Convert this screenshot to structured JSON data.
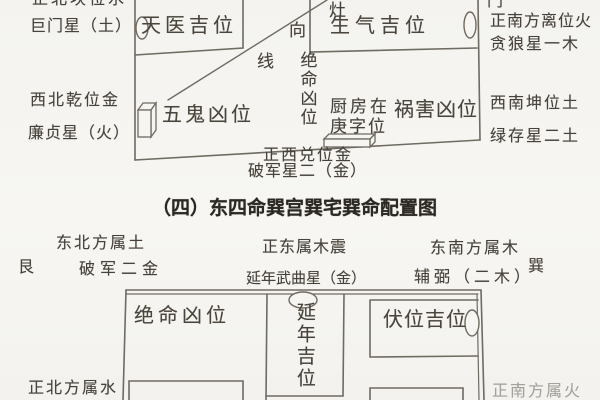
{
  "palette": {
    "paper": "#f6f5f1",
    "ink": "#47423b",
    "line": "#6f6a62",
    "heading_ink": "#2c2923"
  },
  "upper_diagram": {
    "nw_corner": {
      "line1": "正北坎位水",
      "line2": "巨门星（土）"
    },
    "rooms": {
      "tianyi": "天医吉位",
      "shengqi": "生气吉位",
      "wugui": "五鬼凶位",
      "huohai": "祸害凶位"
    },
    "stove_facing_line": {
      "zao": "灶",
      "xiang": "向",
      "xian": "线"
    },
    "jueming_vertical": "绝命凶位",
    "door_label": "门",
    "ne_corner": {
      "line1": "正南方离位火",
      "line2": "贪狼星一木"
    },
    "nw_side": {
      "line1": "西北乾位金",
      "line2": "廉贞星（火）"
    },
    "kitchen_note": {
      "line1": "厨房在",
      "line2": "庚字位"
    },
    "sw_side": {
      "line1": "西南坤位土",
      "line2": "绿存星二土"
    },
    "south_side": {
      "line1": "正西兑位金",
      "line2": "破军星二（金）"
    },
    "edge_mark": "）"
  },
  "section_title": "（四）东四命巽宫巽宅巽命配置图",
  "lower_diagram": {
    "ne_corner": {
      "direction": "东北方属土",
      "trigram": "艮",
      "star": "破军二金"
    },
    "east_side": {
      "direction": "正东属木震",
      "star": "延年武曲星（金）"
    },
    "se_corner": {
      "direction": "东南方属木",
      "trigram": "巽",
      "star": "辅弼（二木）"
    },
    "rooms": {
      "jueming": "绝命凶位",
      "yannian": "延年吉位",
      "fuwei": "伏位吉位"
    },
    "north_label": "正北方属水",
    "south_label": "正南方属火"
  }
}
